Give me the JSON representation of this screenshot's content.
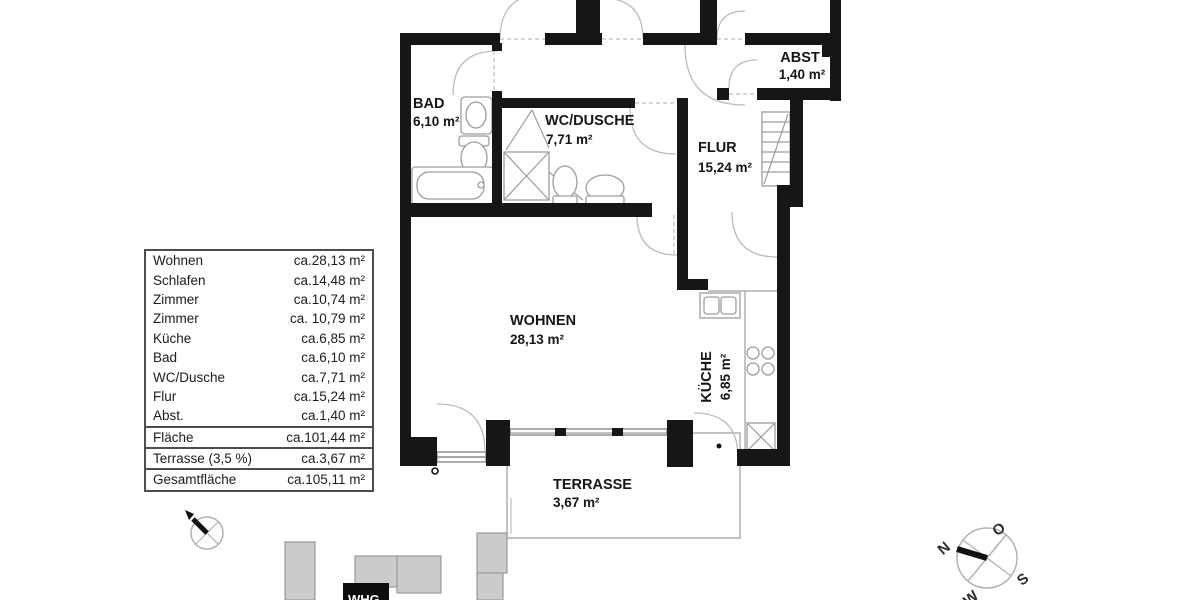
{
  "plan": {
    "rooms": [
      {
        "name": "BAD",
        "area": "6,10 m²"
      },
      {
        "name": "WC/DUSCHE",
        "area": "7,71 m²"
      },
      {
        "name": "FLUR",
        "area": "15,24 m²"
      },
      {
        "name": "ABST",
        "area": "1,40 m²"
      },
      {
        "name": "WOHNEN",
        "area": "28,13 m²"
      },
      {
        "name": "KÜCHE",
        "area": "6,85 m²"
      },
      {
        "name": "TERRASSE",
        "area": "3,67 m²"
      }
    ],
    "site_building_label": "WHG",
    "wall_color": "#161616",
    "building_fill": "#cbcbcb"
  },
  "table": {
    "rows": [
      {
        "label": "Wohnen",
        "value": "ca.28,13 m²"
      },
      {
        "label": "Schlafen",
        "value": "ca.14,48 m²"
      },
      {
        "label": "Zimmer",
        "value": "ca.10,74 m²"
      },
      {
        "label": "Zimmer",
        "value": "ca. 10,79 m²"
      },
      {
        "label": "Küche",
        "value": "ca.6,85 m²"
      },
      {
        "label": "Bad",
        "value": "ca.6,10 m²"
      },
      {
        "label": "WC/Dusche",
        "value": "ca.7,71 m²"
      },
      {
        "label": "Flur",
        "value": "ca.15,24 m²"
      },
      {
        "label": "Abst.",
        "value": "ca.1,40 m²"
      },
      {
        "label": "Fläche",
        "value": "ca.101,44 m²"
      },
      {
        "label": "Terrasse (3,5 %)",
        "value": "ca.3,67 m²"
      },
      {
        "label": "Gesamtfläche",
        "value": "ca.105,11 m²"
      }
    ]
  },
  "compass": {
    "n": "N",
    "o": "O",
    "s": "S",
    "w": "W"
  }
}
